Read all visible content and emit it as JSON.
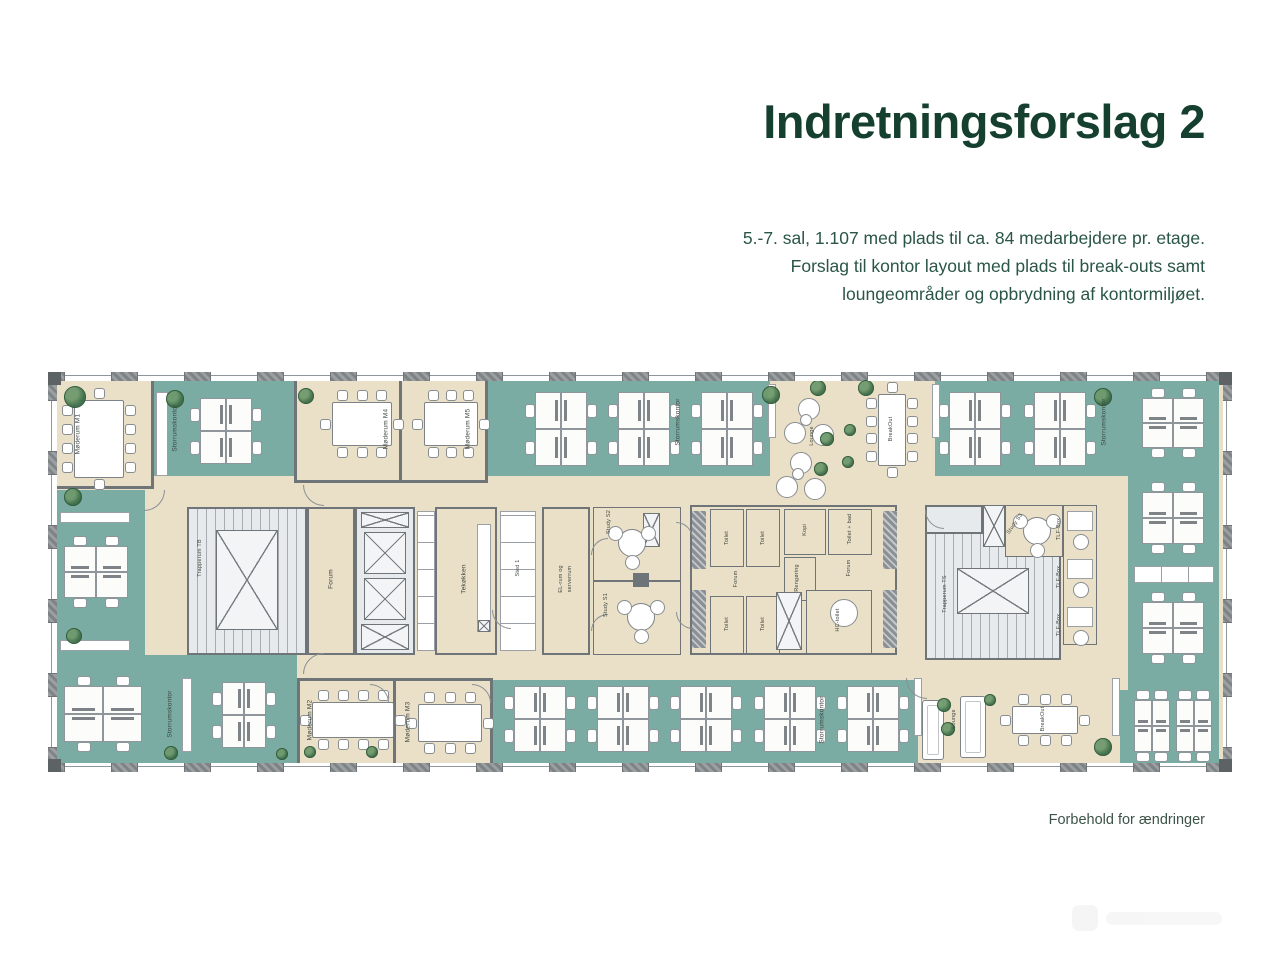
{
  "header": {
    "title": "Indretningsforslag 2",
    "subtitle_lines": [
      "5.-7. sal, 1.107 med plads til ca. 84 medarbejdere pr. etage.",
      "Forslag til kontor layout med plads til break-outs samt",
      "loungeområder og opbrydning af kontormiljøet."
    ]
  },
  "footer": {
    "disclaimer": "Forbehold for ændringer"
  },
  "plan": {
    "rooms": {
      "moderum_m1": "Møderum M1",
      "moderum_m2": "Møderum M2",
      "moderum_m3": "Møderum M3",
      "moderum_m4": "Møderum M4",
      "moderum_m5": "Møderum M5",
      "storrumskontor": "Storrumskontor",
      "breakout": "BreakOut",
      "lounge": "Lounge",
      "trapperum_tb": "Trapperum TB",
      "trapperum_ts": "Trapperum TS",
      "forum": "Forum",
      "tekokken": "Tekøkken",
      "sted_1": "Sted 1",
      "el_rum_1": "EL-rum og",
      "el_rum_2": "serverrum",
      "study_s1": "Study S1",
      "study_s2": "Study S2",
      "study_s3": "Study S3",
      "toilet": "Toilet",
      "toilet_bad": "Toilet + bad",
      "hc_toilet": "HC-toilet",
      "rengoring": "Rengøring",
      "kopi": "Kopi",
      "tlf_box": "TLF-Box"
    }
  },
  "colors": {
    "accent": "#15402F",
    "subtitle_text": "#2A5547",
    "teal_zone": "#7AACA3",
    "floor_beige": "#EADFC7",
    "wall_gray": "#84898D",
    "core_fill": "#E7EAED"
  }
}
